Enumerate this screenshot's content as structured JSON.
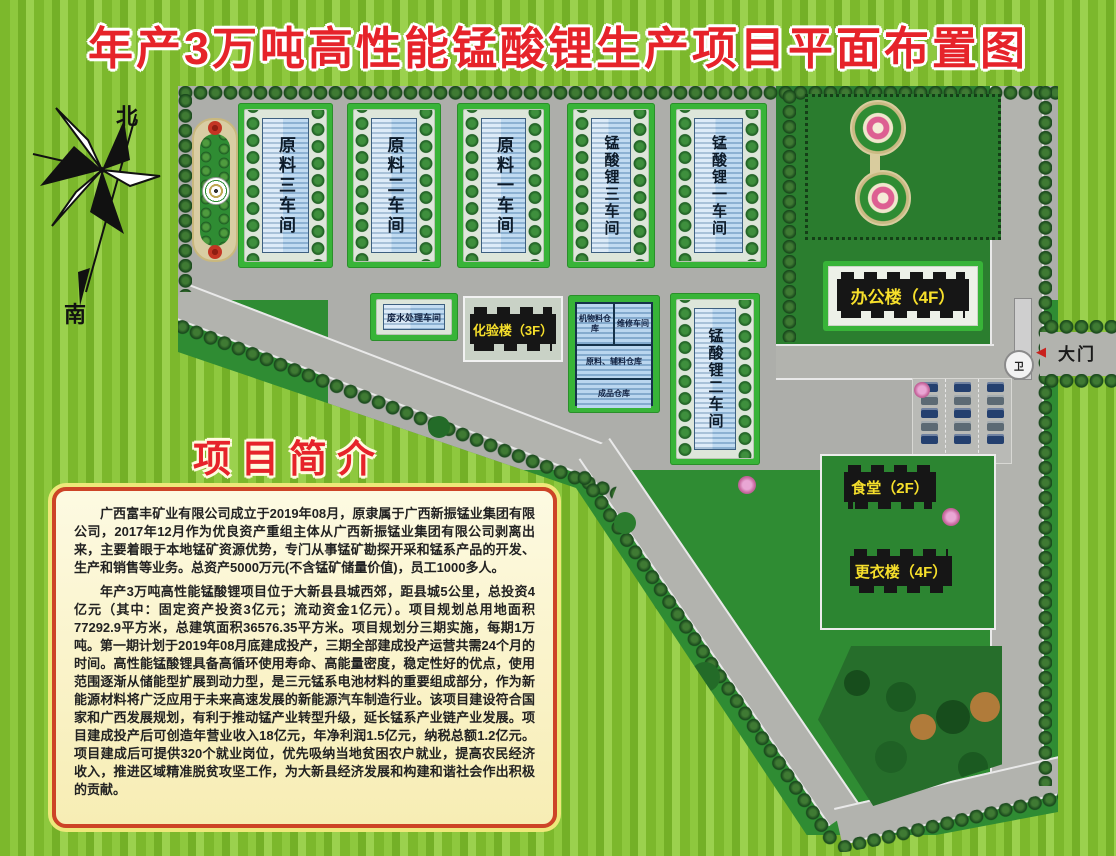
{
  "title": "年产3万吨高性能锰酸锂生产项目平面布置图",
  "compass": {
    "north": "北",
    "south": "南"
  },
  "site": {
    "workshops": [
      {
        "label": "原料三车间"
      },
      {
        "label": "原料二车间"
      },
      {
        "label": "原料一车间"
      },
      {
        "label": "锰酸锂三车间"
      },
      {
        "label": "锰酸锂一车间"
      },
      {
        "label": "锰酸锂二车间"
      }
    ],
    "facilities": {
      "office": "办公楼（4F）",
      "lab": "化验楼（3F）",
      "canteen": "食堂（2F）",
      "locker": "更衣楼（4F）",
      "wastewater": "废水处理车间"
    },
    "warehouses": {
      "packing": "机物料仓库",
      "maintenance": "维修车间",
      "raw_aux": "原料、辅料仓库",
      "finished": "成品仓库"
    },
    "gate": {
      "label": "大门",
      "guard": "卫"
    }
  },
  "intro": {
    "heading": "项目简介",
    "paragraphs": [
      "广西富丰矿业有限公司成立于2019年08月，原隶属于广西新振锰业集团有限公司，2017年12月作为优良资产重组主体从广西新振锰业集团有限公司剥离出来，主要着眼于本地锰矿资源优势，专门从事锰矿勘探开采和锰系产品的开发、生产和销售等业务。总资产5000万元(不含锰矿储量价值)，员工1000多人。",
      "年产3万吨高性能锰酸锂项目位于大新县县城西郊，距县城5公里，总投资4亿元（其中：固定资产投资3亿元；流动资金1亿元）。项目规划总用地面积77292.9平方米，总建筑面积36576.35平方米。项目规划分三期实施，每期1万吨。第一期计划于2019年08月底建成投产，三期全部建成投产运营共需24个月的时间。高性能锰酸锂具备高循环使用寿命、高能量密度，稳定性好的优点，使用范围逐渐从储能型扩展到动力型，是三元锰系电池材料的重要组成部分，作为新能源材料将广泛应用于未来高速发展的新能源汽车制造行业。该项目建设符合国家和广西发展规划，有利于推动锰产业转型升级，延长锰系产业链产业发展。项目建成投产后可创造年营业收入18亿元，年净利润1.5亿元，纳税总额1.2亿元。项目建成后可提供320个就业岗位，优先吸纳当地贫困农户就业，提高农民经济收入，推进区域精准脱贫攻坚工作，为大新县经济发展和构建和谐社会作出积极的贡献。"
    ]
  },
  "colors": {
    "title_red": "#e6232a",
    "label_yellow": "#f6df2b",
    "building_black": "#161616",
    "building_blue": "#a9cdec",
    "lawn_green": "#2f8c33",
    "road_gray": "#adaeaa",
    "box_background": "#fbf5d4",
    "box_border": "#cd4427"
  }
}
